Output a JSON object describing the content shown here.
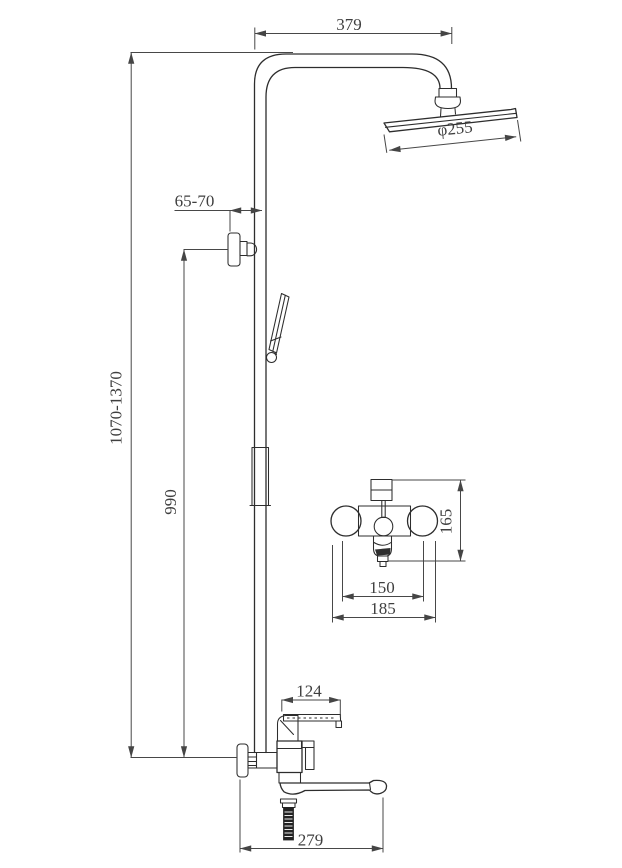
{
  "page": {
    "background": "#ffffff",
    "line_color": "#2d2d2d",
    "dimension_color": "#474747",
    "text_color": "#3f3f3f"
  },
  "drawing": {
    "dims": {
      "arm_reach": "379",
      "head_diameter": "φ255",
      "wall_offset": "65-70",
      "overall_height": "1070-1370",
      "riser_height": "990",
      "mixer_height": "165",
      "mixer_hole_spacing": "150",
      "mixer_body_width": "185",
      "handle_length": "124",
      "spout_reach": "279"
    }
  }
}
